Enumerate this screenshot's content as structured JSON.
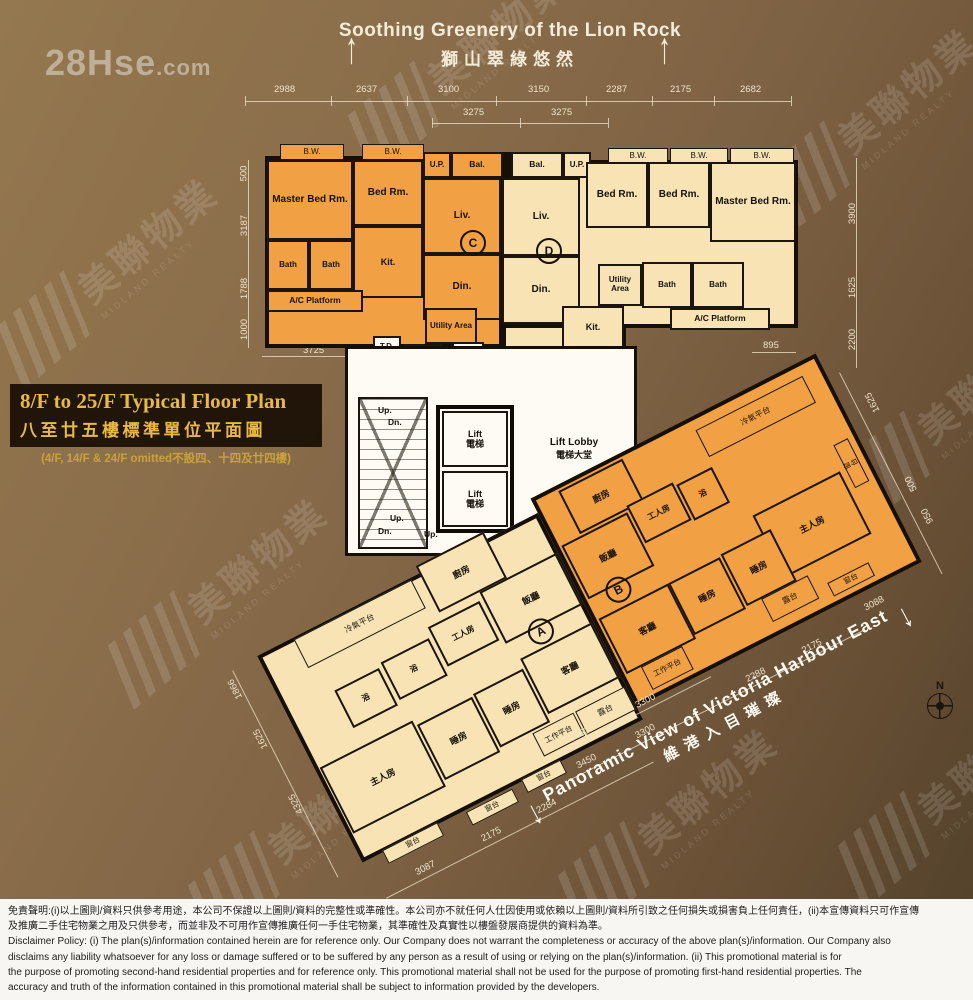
{
  "watermarks": {
    "hse_main": "28Hse",
    "hse_ext": ".com",
    "midland_zh": "美聯物業",
    "midland_en": "MIDLAND REALTY",
    "center_zh": "美聯物",
    "center_hse": "28Hse",
    "footer_id": "28Hse.com #3627471"
  },
  "header": {
    "arrow_up": "↑",
    "title_en": "Soothing Greenery of the Lion Rock",
    "title_zh": "獅山翠綠悠然"
  },
  "title_block": {
    "line_en": "8/F to 25/F Typical Floor Plan",
    "line_zh": "八至廿五樓標準單位平面圖",
    "line_note": "(4/F, 14/F & 24/F omitted不設四、十四及廿四樓)"
  },
  "panoramic": {
    "arrow_down": "↓",
    "text_en": "Panoramic View of Victoria Harbour East",
    "text_zh": "維港入目璀璨"
  },
  "compass": {
    "n": "N"
  },
  "units": {
    "c": "C",
    "d": "D",
    "a": "A",
    "b": "B"
  },
  "labels": {
    "bw": "B.W.",
    "master": "Master Bed Rm.",
    "bed": "Bed Rm.",
    "liv": "Liv.",
    "din": "Din.",
    "kit": "Kit.",
    "bath": "Bath",
    "ac_platform": "A/C Platform",
    "utility": "Utility Area",
    "up": "U.P.",
    "bal": "Bal.",
    "kitchen_zh": "廚房",
    "dining_zh": "飯廳",
    "servant_zh": "工人房",
    "bath_zh": "浴",
    "ac_platform_zh": "冷氣平台",
    "living_zh": "客廳",
    "bed_zh": "睡房",
    "master_zh": "主人房",
    "balcony_zh": "露台",
    "work_platform_zh": "工作平台",
    "bay_zh": "窗台"
  },
  "core": {
    "td": "T.D.",
    "emr": "E.M.R.",
    "hr": "H.R.",
    "lift": "Lift",
    "lift_zh": "電梯",
    "lobby": "Lift Lobby",
    "lobby_zh": "電梯大堂",
    "up": "Up.",
    "dn": "Dn."
  },
  "dims": {
    "top": [
      "2988",
      "2637",
      "3100",
      "3150",
      "2287",
      "2175",
      "2682"
    ],
    "top_sub": [
      "3275",
      "3275"
    ],
    "left": [
      "500",
      "3187",
      "1788",
      "1000"
    ],
    "left_bottom": "3725",
    "right": [
      "3900",
      "1625",
      "2200"
    ],
    "d_ac": "895",
    "wing_left": [
      "1866",
      "1625",
      "4325"
    ],
    "wing_bottom": [
      "3087",
      "2175",
      "2284"
    ],
    "wing_mid_a": [
      "3450",
      "3300"
    ],
    "wing_mid_b": [
      "3450",
      "3300",
      "2288",
      "2175"
    ],
    "wing_right": [
      "1625",
      "500",
      "950",
      "3088"
    ]
  },
  "disclaimer": {
    "zh1": "免責聲明:(i)以上圖則/資料只供參考用途，本公司不保證以上圖則/資料的完整性或準確性。本公司亦不就任何人仕因使用或依賴以上圖則/資料所引致之任何損失或損害負上任何責任，(ii)本宣傳資料只可作宣傳",
    "zh2": "及推廣二手住宅物業之用及只供參考，而並非及不可用作宣傳推廣任何一手住宅物業，其準確性及真實性以樓盤發展商提供的資料為準。",
    "en1": "Disclaimer Policy: (i) The plan(s)/information contained herein are for reference only. Our Company does not warrant the completeness or accuracy of the above plan(s)/information. Our Company also",
    "en2": "disclaims any liability whatsoever for any loss or damage suffered or to be suffered by any person as a result of using or relying on the plan(s)/information. (ii) This promotional material is for",
    "en3": "the purpose of promoting second-hand residential properties and for reference only. This promotional material shall not be used for the purpose of promoting first-hand residential properties. The",
    "en4": "accuracy and truth of the information contained in this promotional material shall be subject to information provided by the developers."
  }
}
